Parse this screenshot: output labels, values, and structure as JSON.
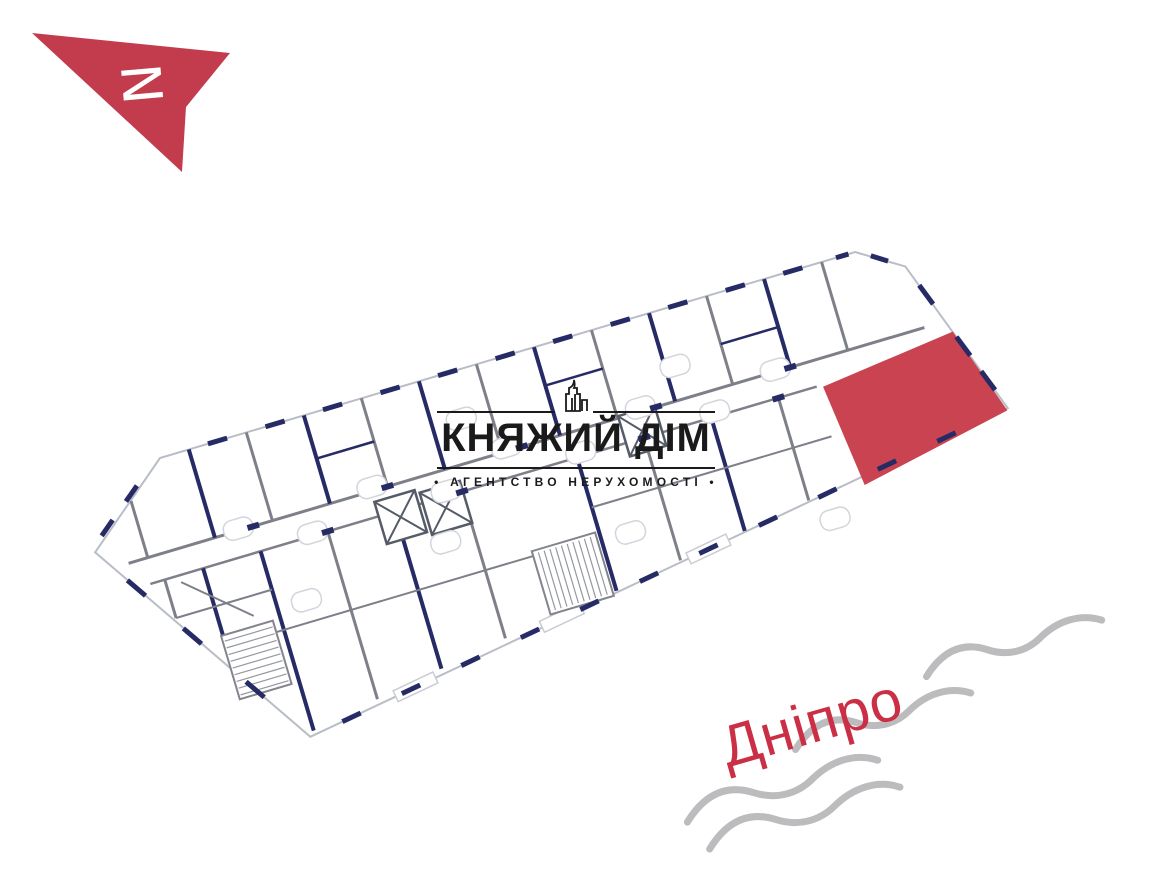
{
  "compass": {
    "letter": "N"
  },
  "logo": {
    "title": "КНЯЖИЙ ДІМ",
    "subtitle": "• АГЕНТСТВО НЕРУХОМОСТІ •"
  },
  "river": {
    "label": "Дніпро"
  },
  "colors": {
    "highlight": "#c94350",
    "compass_arrow": "#c23c4e",
    "river_label": "#cb2f45",
    "wave": "#bcbcbe",
    "wall_navy": "#262b66",
    "wall_gray": "#7e8089",
    "logo_ink": "#1a1a1a"
  }
}
